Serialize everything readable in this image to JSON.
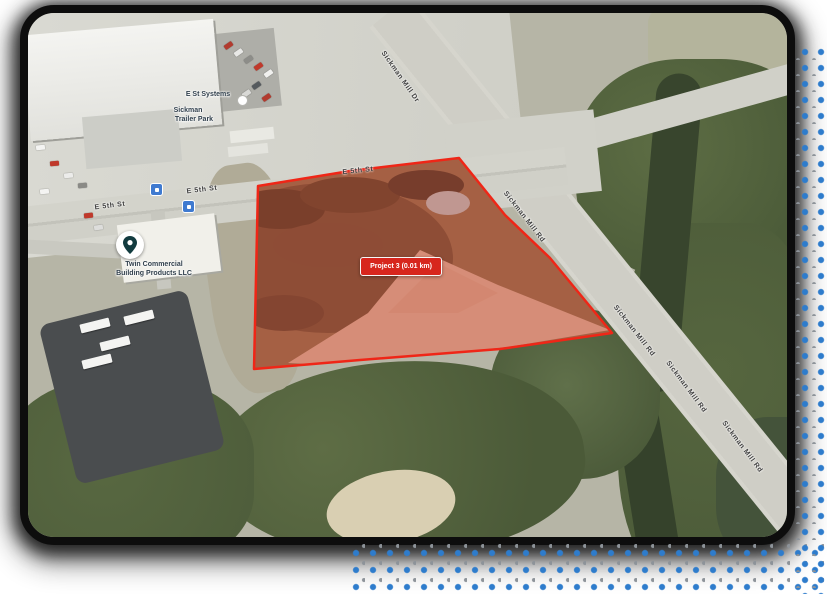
{
  "card": {
    "kind": "satellite-map-view"
  },
  "overlay": {
    "project_chip": "Project 3 (0.01 km)",
    "chip_color": "#d7261d"
  },
  "streets": [
    "E 5th St",
    "E 5th St",
    "E 5th St",
    "Sickman Mill Dr",
    "Sickman Mill Rd",
    "Sickman Mill Rd",
    "Sickman Mill Rd",
    "Sickman Mill Rd"
  ],
  "pois": {
    "business": {
      "line1": "Twin Commercial",
      "line2": "Building Products LLC"
    },
    "systems_label": "E St Systems",
    "park": {
      "line1": "Sickman",
      "line2": "Trailer Park"
    }
  },
  "colors": {
    "polygon_stroke": "#ef2617",
    "polygon_fill": "rgba(235,30,25,0.18)",
    "dots_blue": "#2e7ccc",
    "border": "#0d0d0d"
  }
}
